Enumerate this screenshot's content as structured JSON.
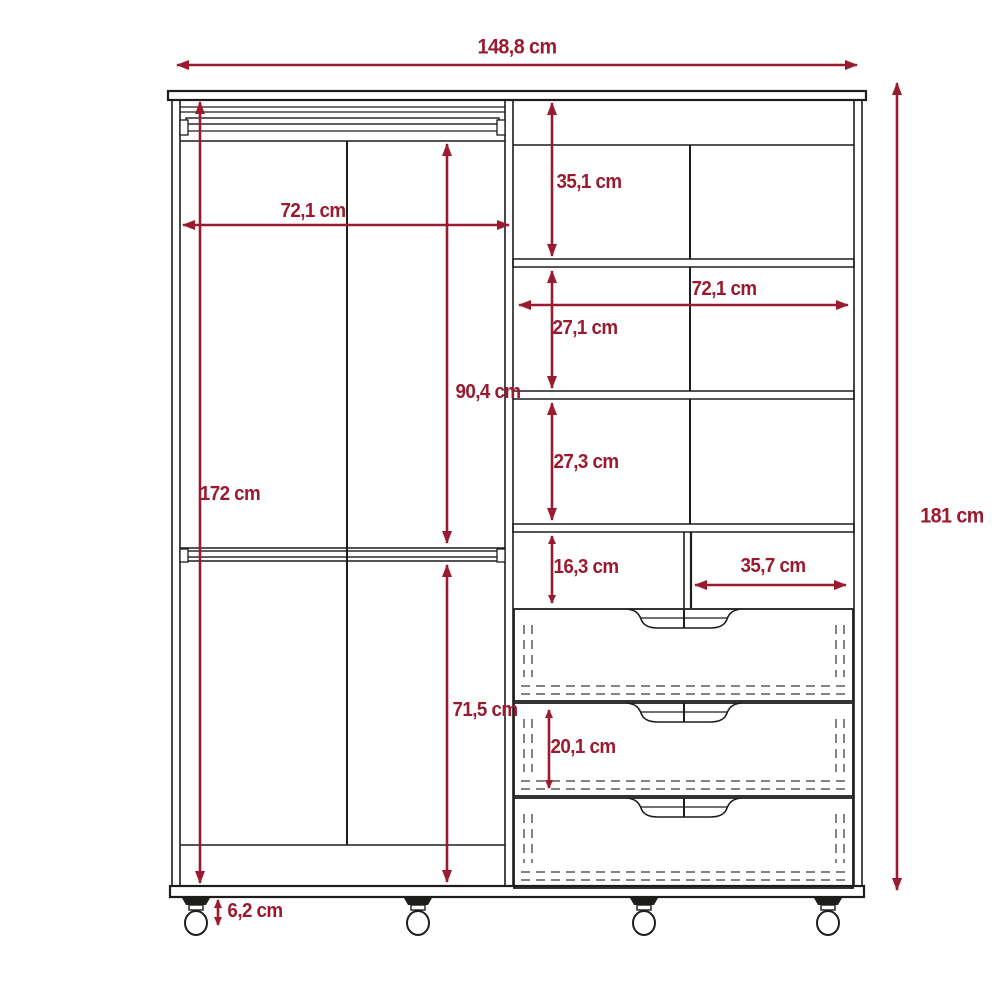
{
  "diagram": {
    "unit": "cm",
    "colors": {
      "dimension_lines": "#9A1B30",
      "cabinet_outline": "#1D1D1B",
      "background": "#FFFFFF"
    },
    "labels": {
      "overall_width": "148,8 cm",
      "overall_height": "181 cm",
      "left_inner_width": "72,1 cm",
      "left_inner_height": "172 cm",
      "upper_hanging_height": "90,4 cm",
      "lower_hanging_height": "71,5 cm",
      "caster_height": "6,2 cm",
      "top_right_section_height": "35,1 cm",
      "right_inner_width": "72,1 cm",
      "second_right_section_height": "27,1 cm",
      "third_right_section_height": "27,3 cm",
      "fourth_right_section_height": "16,3 cm",
      "half_shelf_width": "35,7 cm",
      "drawer_height": "20,1 cm"
    }
  }
}
